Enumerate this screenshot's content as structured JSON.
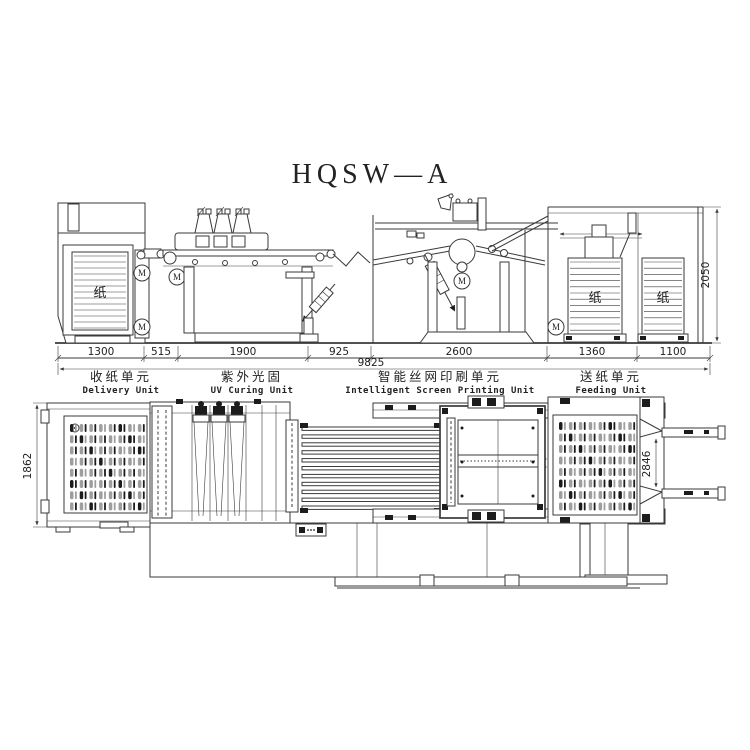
{
  "title": "HQSW—A",
  "labels": {
    "paper": "纸",
    "motor": "M"
  },
  "elevation": {
    "segment_dims": [
      "1300",
      "515",
      "1900",
      "925",
      "2600",
      "1360",
      "1100"
    ],
    "total_dim": "9825",
    "height_dim": "2050"
  },
  "plan": {
    "left_dim": "1862",
    "right_dim": "2846"
  },
  "units": [
    {
      "zh": "收纸单元",
      "en": "Delivery Unit"
    },
    {
      "zh": "紫外光固",
      "en": "UV Curing Unit"
    },
    {
      "zh": "智能丝网印刷单元",
      "en": "Intelligent Screen Printing Unit"
    },
    {
      "zh": "送纸单元",
      "en": "Feeding Unit"
    }
  ],
  "colors": {
    "line": "#3a3a3a",
    "slot_gray": "#9e9e9e",
    "slot_dark": "#1c1c1c",
    "background": "#ffffff"
  }
}
